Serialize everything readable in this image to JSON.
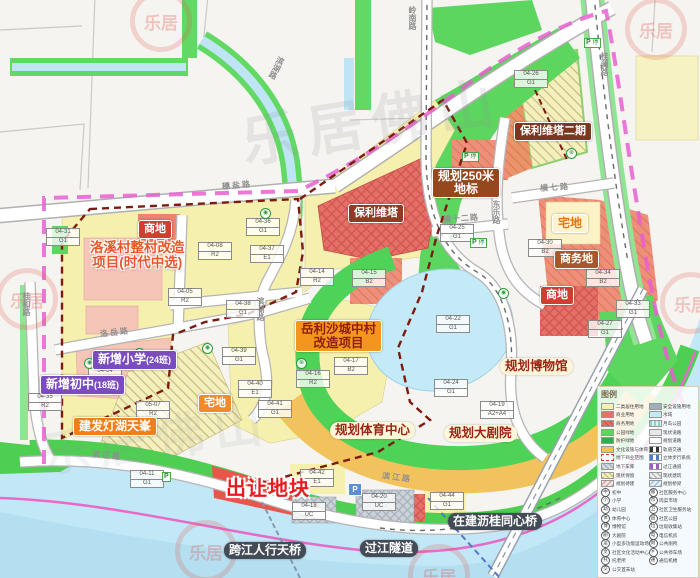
{
  "watermark": {
    "logo": "乐居",
    "big": "乐居佛山"
  },
  "parking": {
    "p": "P",
    "ting": "停"
  },
  "roads": [
    {
      "label": "穗盐路"
    },
    {
      "label": "岭南路"
    },
    {
      "label": "桂澜路"
    },
    {
      "label": "滨湖路"
    },
    {
      "label": "滨湖路"
    },
    {
      "label": "横七路"
    },
    {
      "label": "横十二路"
    },
    {
      "label": "东乐路"
    },
    {
      "label": "洛岳路"
    },
    {
      "label": "桂和路"
    },
    {
      "label": "滨江路"
    },
    {
      "label": "滨江路"
    }
  ],
  "labels": {
    "shangdi_nw": "商地",
    "luoxi1": "洛溪村整村改造",
    "luoxi2": "项目(时代中选)",
    "poly": "保利维塔",
    "poly2": "保利维塔二期",
    "landmark1": "规划250米",
    "landmark2": "地标",
    "zhaidi_e": "宅地",
    "shangwu": "商务地",
    "shangdi_se": "商地",
    "yuelisha1": "岳利沙城中村",
    "yuelisha2": "改造项目",
    "xiaoxue": "新增小学",
    "xiaoxue_sub": "(24班)",
    "chuzhong": "新增初中",
    "chuzhong_sub": "(18班)",
    "zhaidi_w": "宅地",
    "jianfa": "建发灯湖天峯",
    "sports": "规划体育中心",
    "theater": "规划大剧院",
    "museum": "规划博物馆",
    "sell": "出让地块",
    "footbridge": "跨江人行天桥",
    "tunnel": "过江隧道",
    "tongxin": "在建沥桂同心桥"
  },
  "parcels": [
    {
      "code": "04-36",
      "zone": "G1"
    },
    {
      "code": "04-08",
      "zone": "R2"
    },
    {
      "code": "04-37",
      "zone": "E1"
    },
    {
      "code": "04-14",
      "zone": "R2"
    },
    {
      "code": "04-15",
      "zone": "B2"
    },
    {
      "code": "04-05",
      "zone": "R2"
    },
    {
      "code": "04-38",
      "zone": "G1"
    },
    {
      "code": "04-26",
      "zone": "G1"
    },
    {
      "code": "04-25",
      "zone": "G1"
    },
    {
      "code": "04-30",
      "zone": "B2"
    },
    {
      "code": "04-34",
      "zone": "B2"
    },
    {
      "code": "04-27",
      "zone": "G1"
    },
    {
      "code": "04-33",
      "zone": "G1"
    },
    {
      "code": "04-22",
      "zone": "G1"
    },
    {
      "code": "04-24",
      "zone": "G1"
    },
    {
      "code": "04-19",
      "zone": "A2+A4"
    },
    {
      "code": "04-39",
      "zone": "G1"
    },
    {
      "code": "04-40",
      "zone": "E1"
    },
    {
      "code": "04-41",
      "zone": "G1"
    },
    {
      "code": "04-16",
      "zone": "R2"
    },
    {
      "code": "04-17",
      "zone": "B2"
    },
    {
      "code": "04-35",
      "zone": "R2"
    },
    {
      "code": "04-04",
      "zone": "A3"
    },
    {
      "code": "05-07",
      "zone": "R2"
    },
    {
      "code": "04-11",
      "zone": "G1"
    },
    {
      "code": "04-42",
      "zone": "E1"
    },
    {
      "code": "04-18",
      "zone": "UC"
    },
    {
      "code": "04-20",
      "zone": "UC"
    },
    {
      "code": "04-44",
      "zone": "G1"
    },
    {
      "code": "04-31",
      "zone": "G1"
    }
  ],
  "pois": [
    {
      "glyph": "✚"
    },
    {
      "glyph": "⌂"
    },
    {
      "glyph": "⊗"
    },
    {
      "glyph": "◉"
    },
    {
      "glyph": "◉"
    },
    {
      "glyph": "◉"
    },
    {
      "glyph": "⊗"
    },
    {
      "glyph": "◉"
    },
    {
      "glyph": "◉"
    }
  ],
  "legend": {
    "title": "图例",
    "col1": [
      {
        "label": "二类居住用地"
      },
      {
        "label": "商业用地"
      },
      {
        "label": "商务用地"
      },
      {
        "label": "公园绿地"
      },
      {
        "label": "防护绿地"
      },
      {
        "label": "文化设施与体育混合用地"
      },
      {
        "label": "地下商业范围"
      },
      {
        "label": "地下车库"
      },
      {
        "label": "现状保留"
      },
      {
        "label": "规划待建"
      }
    ],
    "col2": [
      {
        "label": "安全设施用地"
      },
      {
        "label": "水域"
      },
      {
        "label": "月岛公园"
      },
      {
        "label": "现状道路"
      },
      {
        "label": "规划道路"
      },
      {
        "label": "轨道交通"
      },
      {
        "label": "立体步行系统"
      },
      {
        "label": "过江通道"
      },
      {
        "label": "现状建筑"
      },
      {
        "label": "规划桥梁"
      }
    ],
    "icons1": [
      {
        "g": "中",
        "label": "初中"
      },
      {
        "g": "小",
        "label": "小学"
      },
      {
        "g": "幼",
        "label": "幼儿园"
      },
      {
        "g": "体",
        "label": "体育中心"
      },
      {
        "g": "博",
        "label": "博物馆"
      },
      {
        "g": "剧",
        "label": "大剧院"
      },
      {
        "g": "运",
        "label": "小型多功能运动场地"
      },
      {
        "g": "文",
        "label": "社区文化活动中心"
      },
      {
        "g": "托",
        "label": "托老所"
      },
      {
        "g": "交",
        "label": "公交首末站"
      }
    ],
    "icons2": [
      {
        "g": "服",
        "label": "社区服务中心"
      },
      {
        "g": "市",
        "label": "肉菜市场"
      },
      {
        "g": "卫",
        "label": "社区卫生服务站"
      },
      {
        "g": "园",
        "label": "社区公园"
      },
      {
        "g": "垃",
        "label": "垃圾收集站"
      },
      {
        "g": "电",
        "label": "电信机房"
      },
      {
        "g": "厕",
        "label": "公共厕所"
      },
      {
        "g": "P",
        "label": "公共停车场"
      },
      {
        "g": "通",
        "label": "通信机楼"
      }
    ]
  },
  "colors": {
    "residential": "#f6f0ae",
    "commercial": "#e4706a",
    "business": "#ee8f79",
    "park": "#5cd65f",
    "protect": "#2fae4e",
    "mixed": "#f2c35c",
    "water": "#c4e9f7",
    "existing": "#f5c6b8",
    "underground": "#ccd2d9",
    "boundary_outer": "#e85fd0",
    "boundary_project": "#7e1b10",
    "badge_dark": "#8e3a26",
    "badge_red": "#cf3d33",
    "badge_purple": "#7a4cc0",
    "badge_orange": "#f08a2a",
    "badge_slate": "#434b57",
    "sell_red": "#e8191f"
  }
}
